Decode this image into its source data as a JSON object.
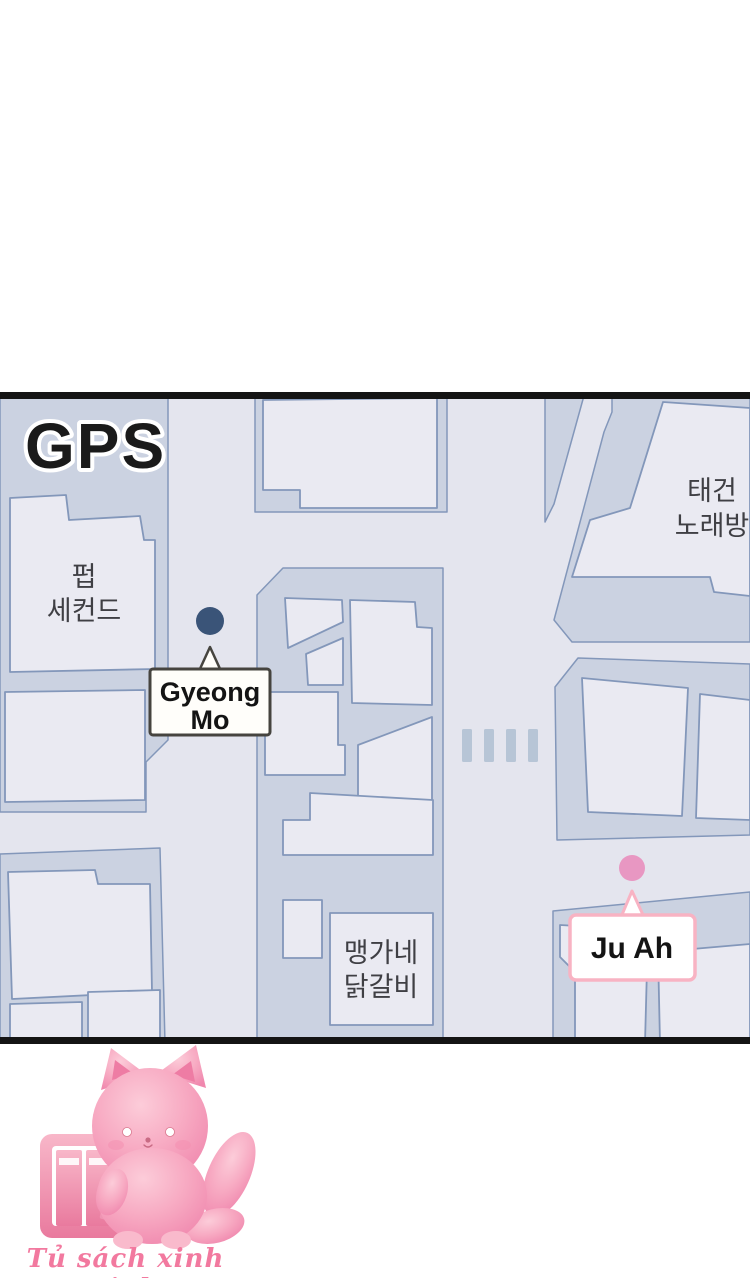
{
  "panel": {
    "gps_label": "GPS",
    "labels": {
      "pub_second": {
        "line1": "펍",
        "line2": "세컨드"
      },
      "taegeon": {
        "line1": "태건",
        "line2": "노래방"
      },
      "maenggane": {
        "line1": "맹가네",
        "line2": "닭갈비"
      }
    },
    "markers": {
      "gyeong_mo": {
        "line1": "Gyeong",
        "line2": "Mo",
        "dot_color": "#3a5478",
        "box_border": "#46443f",
        "box_fill": "#fffefa"
      },
      "ju_ah": {
        "label": "Ju Ah",
        "dot_color": "#e897c2",
        "box_border": "#f8b3c3",
        "box_fill": "#ffffff"
      }
    },
    "colors": {
      "street": "#e4e5ee",
      "lot": "#cbd2e1",
      "building": "#eaeaf2",
      "outline": "#8397ba",
      "crosswalk": "#b7c5d6",
      "panel_border": "#141414",
      "gps_fill": "#1a1a1a",
      "gps_stroke": "#ffffff"
    }
  },
  "footer": {
    "logo_text": "Tủ sách xinh xinh",
    "accent": "#f2799f"
  }
}
